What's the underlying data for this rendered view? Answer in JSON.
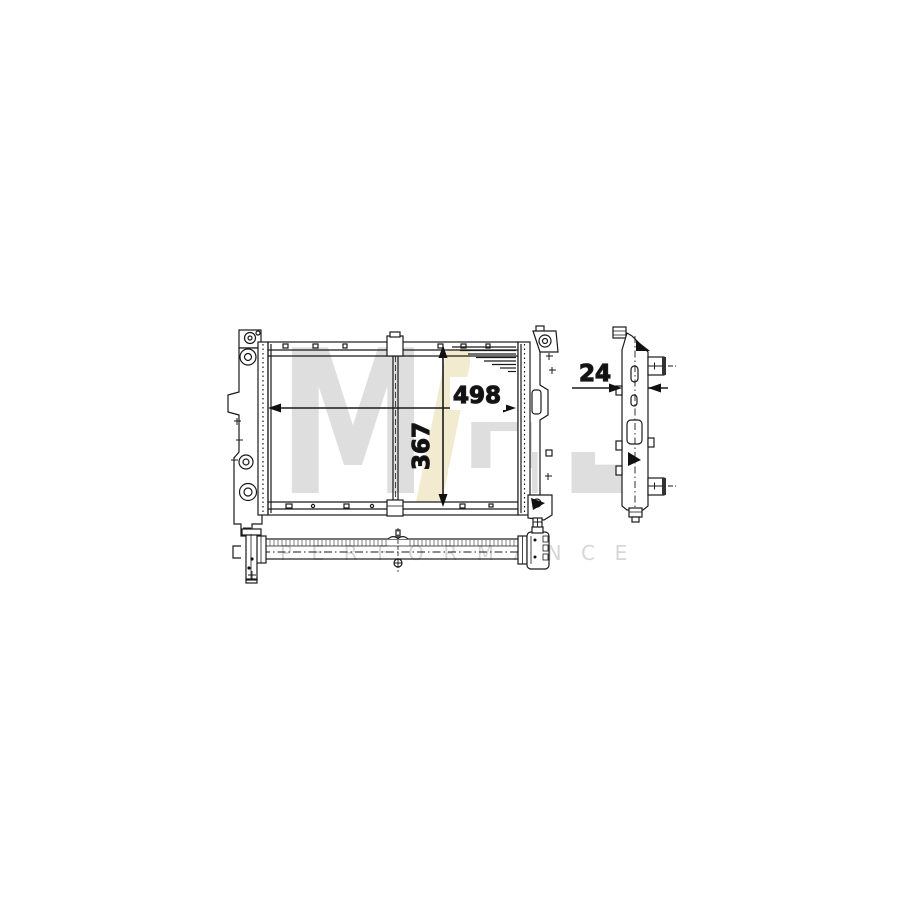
{
  "watermark": {
    "letter_m": "M",
    "letter_h": "H",
    "letter_l": "L",
    "performance": "PERFORMANCE",
    "accent_color": "#f3ebcf",
    "letter_color": "#dedede",
    "performance_color": "#d6d6d6"
  },
  "drawing": {
    "subject": "radiator-technical-drawing",
    "line_color": "#1a1a1a",
    "dimensions": {
      "width_mm": "498",
      "core_height_mm": "367",
      "depth_mm": "24"
    }
  }
}
